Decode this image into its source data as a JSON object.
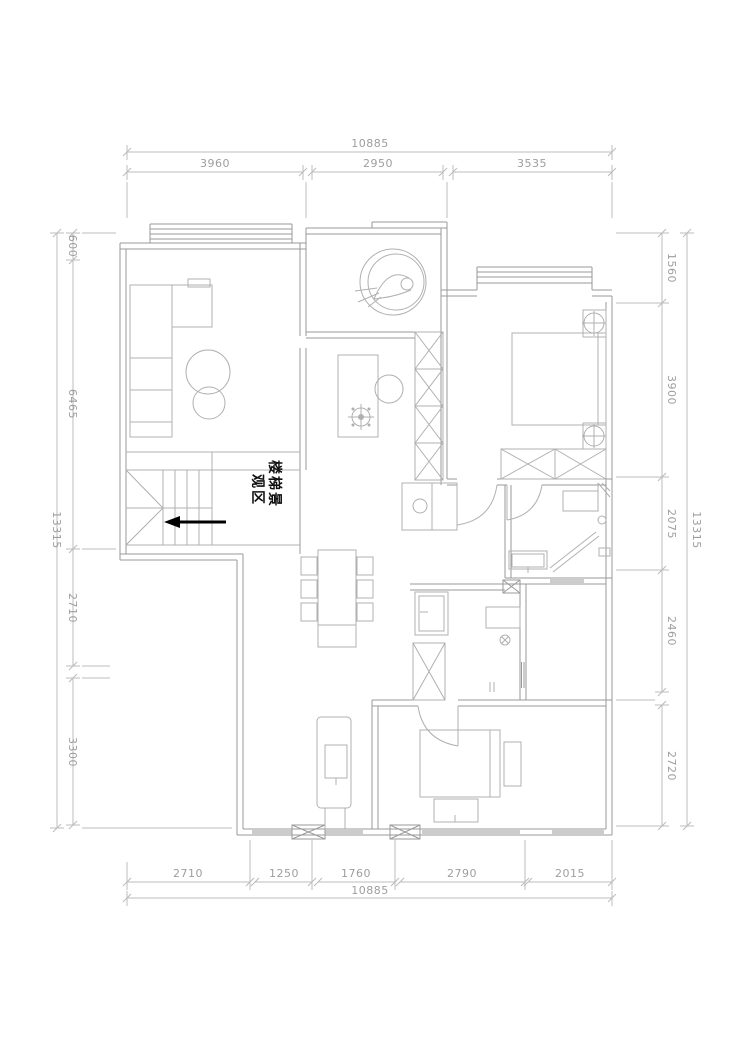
{
  "drawing": {
    "type": "floor-plan",
    "colors": {
      "background": "#FFFFFF",
      "wall_line": "#9A9A9A",
      "furniture_line": "#B0B0B0",
      "dimension_line": "#BCBCBC",
      "dimension_text": "#9E9E9E",
      "annotation_text": "#111111",
      "arrow": "#000000"
    },
    "stair_annotation": {
      "line1": "楼梯景",
      "line2": "观区",
      "full_text": "楼梯景观区"
    },
    "dimensions": {
      "top": {
        "total": "10885",
        "segments": [
          "3960",
          "2950",
          "3535"
        ]
      },
      "bottom": {
        "total": "10885",
        "segments": [
          "2710",
          "1250",
          "1760",
          "2790",
          "2015"
        ]
      },
      "left": {
        "total": "13315",
        "segments": [
          "600",
          "6465",
          "2710",
          "3300"
        ]
      },
      "right": {
        "total": "13315",
        "segments": [
          "1560",
          "3900",
          "2075",
          "2460",
          "2720"
        ]
      }
    }
  }
}
